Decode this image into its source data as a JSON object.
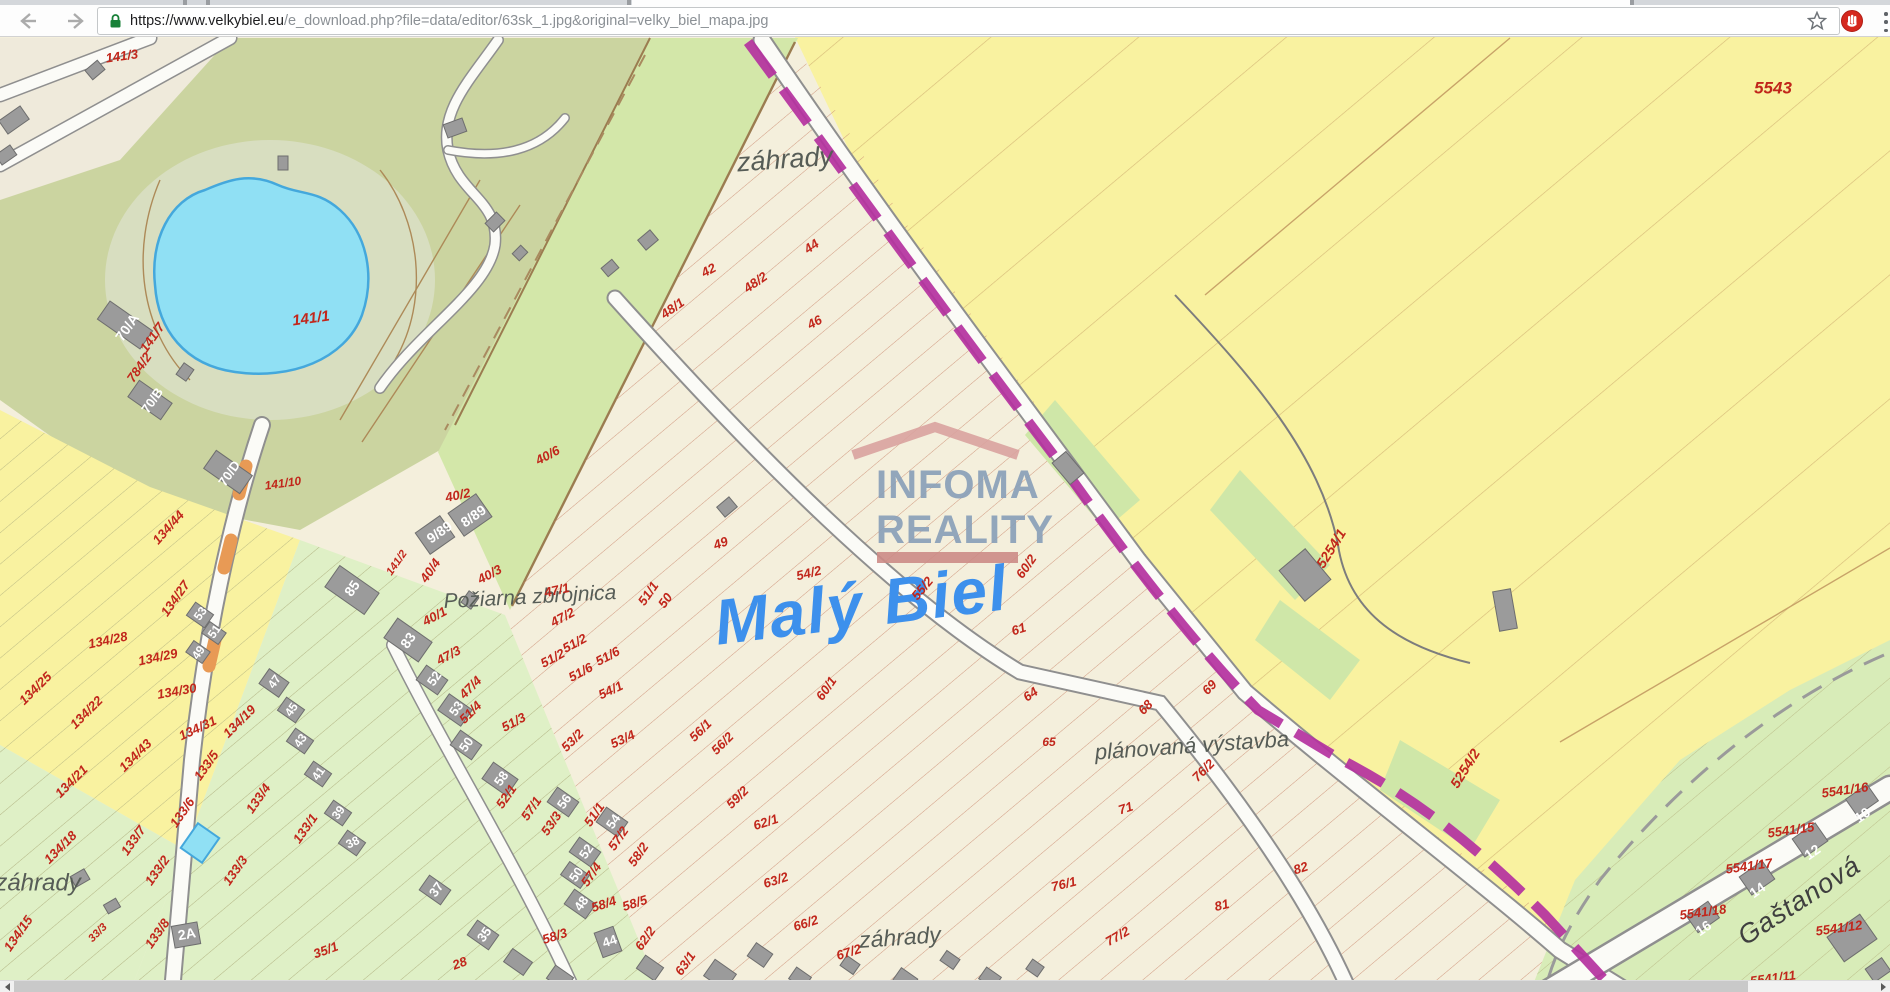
{
  "browser": {
    "url_dark": "https://www.velkybiel.eu",
    "url_gray": "/e_download.php?file=data/editor/63sk_1.jpg&original=velky_biel_mapa.jpg",
    "icons": {
      "back": "arrow-left",
      "forward": "arrow-right",
      "reload": "refresh-circle",
      "lock": "padlock-secure-green",
      "bookmark": "star-outline",
      "extension": "red-circle-hand",
      "menu": "vertical-dots"
    }
  },
  "watermark": {
    "line1": "INFOMA",
    "line2": "REALITY"
  },
  "map": {
    "colors": {
      "cream": "#f4efdc",
      "yellow": "#f9f2a0",
      "olive": "#cbd4a0",
      "green_strip": "#d3e7a9",
      "gardens": "#dff0c6",
      "pond": "#90e0f4",
      "pond_edge": "#44a8dc",
      "boundary_purple": "#b5339f",
      "label_red": "#c1261b",
      "title_blue": "#3d90ec",
      "building_gray": "#9b9b9b"
    },
    "labels": [
      {
        "t": "141/3",
        "x": 122,
        "y": 57,
        "r": -8,
        "s": 13
      },
      {
        "t": "záhrady",
        "x": 785,
        "y": 161,
        "r": -4,
        "k": "place",
        "s": 27
      },
      {
        "t": "42",
        "x": 709,
        "y": 271,
        "r": -28
      },
      {
        "t": "44",
        "x": 812,
        "y": 247,
        "r": -35
      },
      {
        "t": "48/2",
        "x": 756,
        "y": 283,
        "r": -35
      },
      {
        "t": "48/1",
        "x": 673,
        "y": 309,
        "r": -35
      },
      {
        "t": "46",
        "x": 815,
        "y": 323,
        "r": -28
      },
      {
        "t": "40/6",
        "x": 548,
        "y": 456,
        "r": -28
      },
      {
        "t": "5543",
        "x": 1773,
        "y": 89,
        "r": 0,
        "s": 17
      },
      {
        "t": "141/1",
        "x": 311,
        "y": 319,
        "r": -8,
        "s": 15
      },
      {
        "t": "141/7",
        "x": 153,
        "y": 338,
        "r": -55
      },
      {
        "t": "784/2",
        "x": 140,
        "y": 368,
        "r": -55
      },
      {
        "t": "141/10",
        "x": 283,
        "y": 484,
        "r": -8,
        "s": 12
      },
      {
        "t": "134/44",
        "x": 169,
        "y": 528,
        "r": -48
      },
      {
        "t": "134/27",
        "x": 176,
        "y": 599,
        "r": -55
      },
      {
        "t": "134/28",
        "x": 108,
        "y": 641,
        "r": -12
      },
      {
        "t": "134/29",
        "x": 158,
        "y": 658,
        "r": -12
      },
      {
        "t": "134/30",
        "x": 177,
        "y": 692,
        "r": -10
      },
      {
        "t": "134/25",
        "x": 36,
        "y": 689,
        "r": -45
      },
      {
        "t": "134/22",
        "x": 87,
        "y": 713,
        "r": -45
      },
      {
        "t": "134/21",
        "x": 72,
        "y": 782,
        "r": -45
      },
      {
        "t": "134/43",
        "x": 136,
        "y": 756,
        "r": -45
      },
      {
        "t": "134/18",
        "x": 61,
        "y": 848,
        "r": -45
      },
      {
        "t": "134/31",
        "x": 198,
        "y": 729,
        "r": -25
      },
      {
        "t": "134/19",
        "x": 240,
        "y": 722,
        "r": -45
      },
      {
        "t": "133/5",
        "x": 207,
        "y": 766,
        "r": -55
      },
      {
        "t": "133/6",
        "x": 183,
        "y": 813,
        "r": -55
      },
      {
        "t": "133/7",
        "x": 134,
        "y": 841,
        "r": -55
      },
      {
        "t": "133/4",
        "x": 259,
        "y": 799,
        "r": -55
      },
      {
        "t": "133/2",
        "x": 158,
        "y": 871,
        "r": -55
      },
      {
        "t": "133/3",
        "x": 236,
        "y": 871,
        "r": -55
      },
      {
        "t": "133/1",
        "x": 306,
        "y": 829,
        "r": -55
      },
      {
        "t": "133/8",
        "x": 158,
        "y": 934,
        "r": -55
      },
      {
        "t": "134/15",
        "x": 19,
        "y": 934,
        "r": -55
      },
      {
        "t": "33/3",
        "x": 98,
        "y": 933,
        "r": -45,
        "s": 11
      },
      {
        "t": "35/1",
        "x": 326,
        "y": 951,
        "r": -20
      },
      {
        "t": "28",
        "x": 460,
        "y": 964,
        "r": -20
      },
      {
        "t": "záhrady",
        "x": 38,
        "y": 884,
        "r": 0,
        "k": "place",
        "s": 24
      },
      {
        "t": "záhrady",
        "x": 900,
        "y": 939,
        "r": -4,
        "k": "place",
        "s": 23
      },
      {
        "t": "Požiarna zbrojnica",
        "x": 530,
        "y": 598,
        "r": -3,
        "k": "place",
        "s": 21
      },
      {
        "t": "plánovaná výstavba",
        "x": 1192,
        "y": 747,
        "r": -4,
        "k": "place",
        "s": 22
      },
      {
        "t": "Gaštanová",
        "x": 1800,
        "y": 902,
        "r": -33,
        "k": "street",
        "s": 27
      },
      {
        "t": "Malý Biel",
        "x": 862,
        "y": 610,
        "r": -7,
        "k": "blue",
        "s": 64
      },
      {
        "t": "40/2",
        "x": 458,
        "y": 496,
        "r": -12
      },
      {
        "t": "141/2",
        "x": 397,
        "y": 563,
        "r": -55,
        "s": 11
      },
      {
        "t": "40/4",
        "x": 431,
        "y": 571,
        "r": -55
      },
      {
        "t": "40/3",
        "x": 490,
        "y": 575,
        "r": -28
      },
      {
        "t": "40/1",
        "x": 435,
        "y": 617,
        "r": -28
      },
      {
        "t": "47/1",
        "x": 557,
        "y": 591,
        "r": -12
      },
      {
        "t": "47/2",
        "x": 563,
        "y": 618,
        "r": -28
      },
      {
        "t": "51/2",
        "x": 575,
        "y": 644,
        "r": -28
      },
      {
        "t": "51/6",
        "x": 608,
        "y": 657,
        "r": -28
      },
      {
        "t": "51/1",
        "x": 649,
        "y": 594,
        "r": -55
      },
      {
        "t": "49",
        "x": 721,
        "y": 544,
        "r": -20
      },
      {
        "t": "50",
        "x": 666,
        "y": 601,
        "r": -55
      },
      {
        "t": "54/2",
        "x": 809,
        "y": 574,
        "r": -14
      },
      {
        "t": "55/2",
        "x": 923,
        "y": 589,
        "r": -50
      },
      {
        "t": "60/2",
        "x": 1027,
        "y": 567,
        "r": -55
      },
      {
        "t": "61",
        "x": 1019,
        "y": 630,
        "r": -18
      },
      {
        "t": "64",
        "x": 1031,
        "y": 695,
        "r": -35
      },
      {
        "t": "60/1",
        "x": 827,
        "y": 689,
        "r": -55
      },
      {
        "t": "65",
        "x": 1049,
        "y": 743,
        "r": 0,
        "s": 12
      },
      {
        "t": "68",
        "x": 1146,
        "y": 708,
        "r": -45
      },
      {
        "t": "69",
        "x": 1210,
        "y": 688,
        "r": -45
      },
      {
        "t": "71",
        "x": 1126,
        "y": 809,
        "r": -18
      },
      {
        "t": "76/2",
        "x": 1204,
        "y": 771,
        "r": -45
      },
      {
        "t": "76/1",
        "x": 1064,
        "y": 885,
        "r": -14
      },
      {
        "t": "77/2",
        "x": 1118,
        "y": 937,
        "r": -30
      },
      {
        "t": "81",
        "x": 1222,
        "y": 906,
        "r": -14
      },
      {
        "t": "82",
        "x": 1301,
        "y": 869,
        "r": -18
      },
      {
        "t": "47/3",
        "x": 449,
        "y": 656,
        "r": -28
      },
      {
        "t": "47/4",
        "x": 471,
        "y": 688,
        "r": -45
      },
      {
        "t": "51/2",
        "x": 553,
        "y": 659,
        "r": -28
      },
      {
        "t": "51/6",
        "x": 581,
        "y": 673,
        "r": -28
      },
      {
        "t": "51/4",
        "x": 471,
        "y": 713,
        "r": -45
      },
      {
        "t": "51/3",
        "x": 514,
        "y": 723,
        "r": -28
      },
      {
        "t": "54/1",
        "x": 611,
        "y": 691,
        "r": -25
      },
      {
        "t": "53/2",
        "x": 573,
        "y": 741,
        "r": -45
      },
      {
        "t": "53/4",
        "x": 623,
        "y": 740,
        "r": -25
      },
      {
        "t": "56/1",
        "x": 701,
        "y": 731,
        "r": -45
      },
      {
        "t": "56/2",
        "x": 723,
        "y": 744,
        "r": -45
      },
      {
        "t": "59/2",
        "x": 738,
        "y": 798,
        "r": -45
      },
      {
        "t": "62/1",
        "x": 766,
        "y": 823,
        "r": -18
      },
      {
        "t": "63/2",
        "x": 776,
        "y": 881,
        "r": -18
      },
      {
        "t": "66/2",
        "x": 806,
        "y": 924,
        "r": -18
      },
      {
        "t": "67/2",
        "x": 849,
        "y": 953,
        "r": -18
      },
      {
        "t": "52/1",
        "x": 507,
        "y": 797,
        "r": -55
      },
      {
        "t": "57/1",
        "x": 532,
        "y": 809,
        "r": -55
      },
      {
        "t": "53/3",
        "x": 552,
        "y": 824,
        "r": -55
      },
      {
        "t": "51/1",
        "x": 595,
        "y": 815,
        "r": -55
      },
      {
        "t": "57/2",
        "x": 619,
        "y": 839,
        "r": -55
      },
      {
        "t": "58/2",
        "x": 639,
        "y": 855,
        "r": -55
      },
      {
        "t": "57/4",
        "x": 592,
        "y": 875,
        "r": -55
      },
      {
        "t": "58/4",
        "x": 604,
        "y": 905,
        "r": -18
      },
      {
        "t": "58/5",
        "x": 635,
        "y": 904,
        "r": -18
      },
      {
        "t": "58/3",
        "x": 555,
        "y": 937,
        "r": -18
      },
      {
        "t": "62/2",
        "x": 646,
        "y": 939,
        "r": -55
      },
      {
        "t": "63/1",
        "x": 686,
        "y": 964,
        "r": -55
      },
      {
        "t": "5254/1",
        "x": 1332,
        "y": 549,
        "r": -58,
        "s": 14
      },
      {
        "t": "5254/2",
        "x": 1466,
        "y": 769,
        "r": -58,
        "s": 14
      },
      {
        "t": "5541/16",
        "x": 1845,
        "y": 791,
        "r": -8
      },
      {
        "t": "5541/15",
        "x": 1791,
        "y": 831,
        "r": -8
      },
      {
        "t": "5541/17",
        "x": 1749,
        "y": 867,
        "r": -8
      },
      {
        "t": "5541/18",
        "x": 1703,
        "y": 913,
        "r": -8
      },
      {
        "t": "5541/12",
        "x": 1839,
        "y": 929,
        "r": -8
      },
      {
        "t": "5541/11",
        "x": 1773,
        "y": 979,
        "r": -8
      },
      {
        "t": "70/A",
        "x": 128,
        "y": 328,
        "r": -55,
        "k": "bld",
        "s": 14
      },
      {
        "t": "70/B",
        "x": 153,
        "y": 401,
        "r": -55,
        "k": "bld",
        "s": 13
      },
      {
        "t": "70/D",
        "x": 230,
        "y": 474,
        "r": -55,
        "k": "bld",
        "s": 13
      },
      {
        "t": "9/89",
        "x": 440,
        "y": 533,
        "r": -35,
        "k": "bld",
        "s": 14
      },
      {
        "t": "8/89",
        "x": 474,
        "y": 517,
        "r": -35,
        "k": "bld",
        "s": 14
      },
      {
        "t": "85",
        "x": 353,
        "y": 589,
        "r": -55,
        "k": "bld",
        "s": 14
      },
      {
        "t": "83",
        "x": 409,
        "y": 641,
        "r": -55,
        "k": "bld",
        "s": 14
      },
      {
        "t": "2A",
        "x": 187,
        "y": 935,
        "r": -10,
        "k": "bld",
        "s": 14
      },
      {
        "t": "53",
        "x": 201,
        "y": 614,
        "r": -55,
        "k": "bld",
        "s": 12
      },
      {
        "t": "51",
        "x": 215,
        "y": 632,
        "r": -55,
        "k": "bld",
        "s": 12
      },
      {
        "t": "49",
        "x": 199,
        "y": 653,
        "r": -55,
        "k": "bld",
        "s": 12
      },
      {
        "t": "47",
        "x": 275,
        "y": 682,
        "r": -55,
        "k": "bld",
        "s": 12
      },
      {
        "t": "45",
        "x": 292,
        "y": 710,
        "r": -55,
        "k": "bld",
        "s": 12
      },
      {
        "t": "43",
        "x": 301,
        "y": 741,
        "r": -55,
        "k": "bld",
        "s": 12
      },
      {
        "t": "41",
        "x": 319,
        "y": 774,
        "r": -55,
        "k": "bld",
        "s": 12
      },
      {
        "t": "39",
        "x": 339,
        "y": 813,
        "r": -55,
        "k": "bld",
        "s": 12
      },
      {
        "t": "38",
        "x": 353,
        "y": 843,
        "r": -25,
        "k": "bld",
        "s": 12
      },
      {
        "t": "52",
        "x": 435,
        "y": 679,
        "r": -55,
        "k": "bld",
        "s": 13
      },
      {
        "t": "53",
        "x": 457,
        "y": 709,
        "r": -55,
        "k": "bld",
        "s": 13
      },
      {
        "t": "50",
        "x": 467,
        "y": 745,
        "r": -55,
        "k": "bld",
        "s": 13
      },
      {
        "t": "58",
        "x": 502,
        "y": 779,
        "r": -55,
        "k": "bld",
        "s": 13
      },
      {
        "t": "56",
        "x": 565,
        "y": 802,
        "r": -55,
        "k": "bld",
        "s": 13
      },
      {
        "t": "54",
        "x": 614,
        "y": 822,
        "r": -55,
        "k": "bld",
        "s": 13
      },
      {
        "t": "52",
        "x": 587,
        "y": 852,
        "r": -55,
        "k": "bld",
        "s": 13
      },
      {
        "t": "50",
        "x": 577,
        "y": 875,
        "r": -55,
        "k": "bld",
        "s": 13
      },
      {
        "t": "48",
        "x": 582,
        "y": 904,
        "r": -55,
        "k": "bld",
        "s": 13
      },
      {
        "t": "37",
        "x": 437,
        "y": 890,
        "r": -55,
        "k": "bld",
        "s": 13
      },
      {
        "t": "35",
        "x": 485,
        "y": 935,
        "r": -55,
        "k": "bld",
        "s": 13
      },
      {
        "t": "44",
        "x": 610,
        "y": 942,
        "r": -18,
        "k": "bld",
        "s": 13
      },
      {
        "t": "10",
        "x": 1863,
        "y": 816,
        "r": -35,
        "k": "bld",
        "s": 14
      },
      {
        "t": "12",
        "x": 1813,
        "y": 853,
        "r": -35,
        "k": "bld",
        "s": 14
      },
      {
        "t": "14",
        "x": 1758,
        "y": 891,
        "r": -35,
        "k": "bld",
        "s": 14
      },
      {
        "t": "16",
        "x": 1704,
        "y": 929,
        "r": -35,
        "k": "bld",
        "s": 14
      }
    ]
  }
}
